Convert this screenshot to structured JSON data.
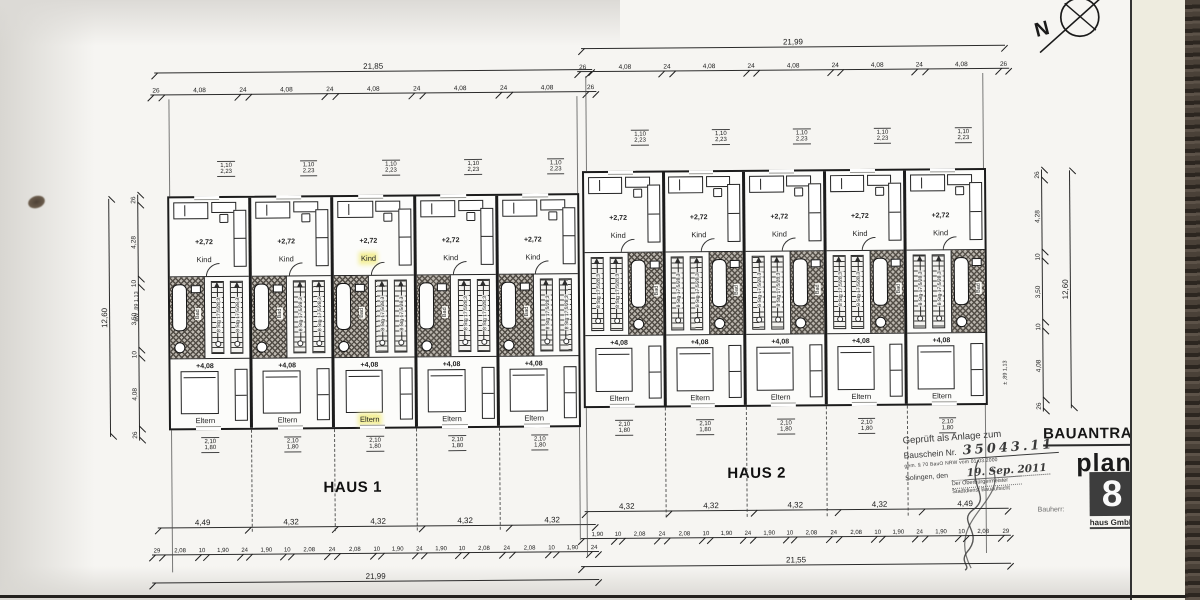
{
  "compass": {
    "label": "N"
  },
  "rooms": {
    "kind_label": "Kind",
    "kind_level": "+2,72",
    "eltern_label": "Eltern",
    "eltern_level": "+4,08",
    "bad_label": "Bad",
    "stair_note": "8 Stg 17,5/28,3"
  },
  "haus1": {
    "label": "HAUS 1",
    "top": {
      "overall": "21,85",
      "segments": [
        "26",
        "4,08",
        "24",
        "4,08",
        "24",
        "4,08",
        "24",
        "4,08",
        "24",
        "4,08",
        "26"
      ]
    },
    "top_window_dim": {
      "a": "1,10",
      "b": "2,23"
    },
    "bottom_window_dim": {
      "a": "2,10",
      "b": "1,80"
    },
    "bottom": {
      "main": [
        "4,49",
        "4,32",
        "4,32",
        "4,32",
        "4,32"
      ],
      "detail": [
        "29",
        "2,08",
        "10",
        "1,90",
        "24",
        "1,90",
        "10",
        "2,08",
        "24",
        "2,08",
        "10",
        "1,90",
        "24",
        "1,90",
        "10",
        "2,08",
        "24",
        "2,08",
        "10",
        "1,90",
        "24"
      ],
      "overall": "21,99"
    },
    "side": {
      "overall": "12,60",
      "segments": [
        "26",
        "4,28",
        "10",
        "3,50",
        "10",
        "4,08",
        "26"
      ],
      "note": "BW ,89  1,13"
    },
    "units": [
      {
        "highlight": false
      },
      {
        "highlight": false
      },
      {
        "highlight": true
      },
      {
        "highlight": false
      },
      {
        "highlight": false
      }
    ]
  },
  "haus2": {
    "label": "HAUS 2",
    "top": {
      "overall": "21,99",
      "segments": [
        "26",
        "4,08",
        "24",
        "4,08",
        "24",
        "4,08",
        "24",
        "4,08",
        "24",
        "4,08",
        "26"
      ]
    },
    "top_window_dim": {
      "a": "1,10",
      "b": "2,23"
    },
    "bottom_window_dim": {
      "a": "2,10",
      "b": "1,80"
    },
    "bottom": {
      "main": [
        "4,32",
        "4,32",
        "4,32",
        "4,32",
        "4,49"
      ],
      "detail": [
        "1,90",
        "10",
        "2,08",
        "24",
        "2,08",
        "10",
        "1,90",
        "24",
        "1,90",
        "10",
        "2,08",
        "24",
        "2,08",
        "10",
        "1,90",
        "24",
        "1,90",
        "10",
        "2,08",
        "29"
      ],
      "overall": "21,55"
    },
    "side": {
      "overall": "12,60",
      "segments": [
        "26",
        "4,28",
        "10",
        "3,50",
        "10",
        "4,08",
        "26"
      ],
      "note": "± ,89  1,13"
    },
    "units": [
      {
        "highlight": false
      },
      {
        "highlight": false
      },
      {
        "highlight": false
      },
      {
        "highlight": false
      },
      {
        "highlight": false
      }
    ]
  },
  "stamp": {
    "line1": "Geprüft als Anlage zum",
    "line2_label": "Bauschein Nr.",
    "line2_value": "35043.11",
    "line3": "gem. § 70 BauO NRW vom 01.03.2000",
    "line4_label": "Solingen, den",
    "line4_value": "19. Sep. 2011",
    "line5": "Der Oberbürgermeister",
    "line6": "Stadtdienst Bauaufsicht"
  },
  "titleblock": {
    "title": "BAUANTRAG",
    "logo_word": "plan",
    "logo_digit": "8",
    "logo_sub": "haus GmbH",
    "side_label": "Bauherr:"
  }
}
